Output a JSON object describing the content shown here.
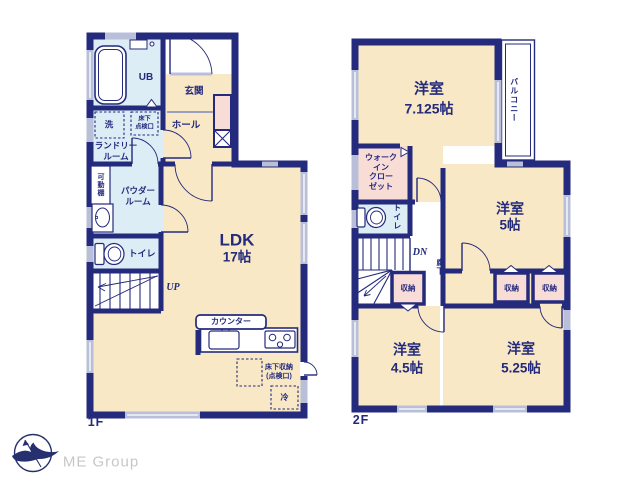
{
  "f1": {
    "floor": "1F",
    "ub": "UB",
    "genkan": "玄関",
    "hall": "ホール",
    "wash": "洗",
    "hatch": "床下\n点検口",
    "laundry": "ランドリー\nルーム",
    "shelf": "可動棚",
    "powder": "パウダー\nルーム",
    "toilet": "トイレ",
    "up": "UP",
    "ldk": "LDK",
    "ldk_size": "17帖",
    "counter": "カウンター",
    "floor_storage": "床下収納\n(点検口)",
    "fridge": "冷"
  },
  "f2": {
    "floor": "2F",
    "room7": "洋室",
    "room7_size": "7.125帖",
    "balcony": "バルコニー",
    "wic": "ウォーク\nイン\nクロー\nゼット",
    "toilet": "トイレ",
    "dn": "DN",
    "hallway": "廊下",
    "closet_a": "収納",
    "closet_b": "収納",
    "closet_c": "収納",
    "room5": "洋室",
    "room5_size": "5帖",
    "room45": "洋室",
    "room45_size": "4.5帖",
    "room525": "洋室",
    "room525_size": "5.25帖"
  },
  "logo": {
    "name": "ME Group"
  },
  "colors": {
    "wall_navy": "#242a7c",
    "room_cream": "#f8e8c6",
    "wet_blue": "#ddedf6",
    "closet_pink": "#f8dcd6",
    "window_gray": "#b9bfd9",
    "logo_text_gray": "#c7c7c7"
  }
}
